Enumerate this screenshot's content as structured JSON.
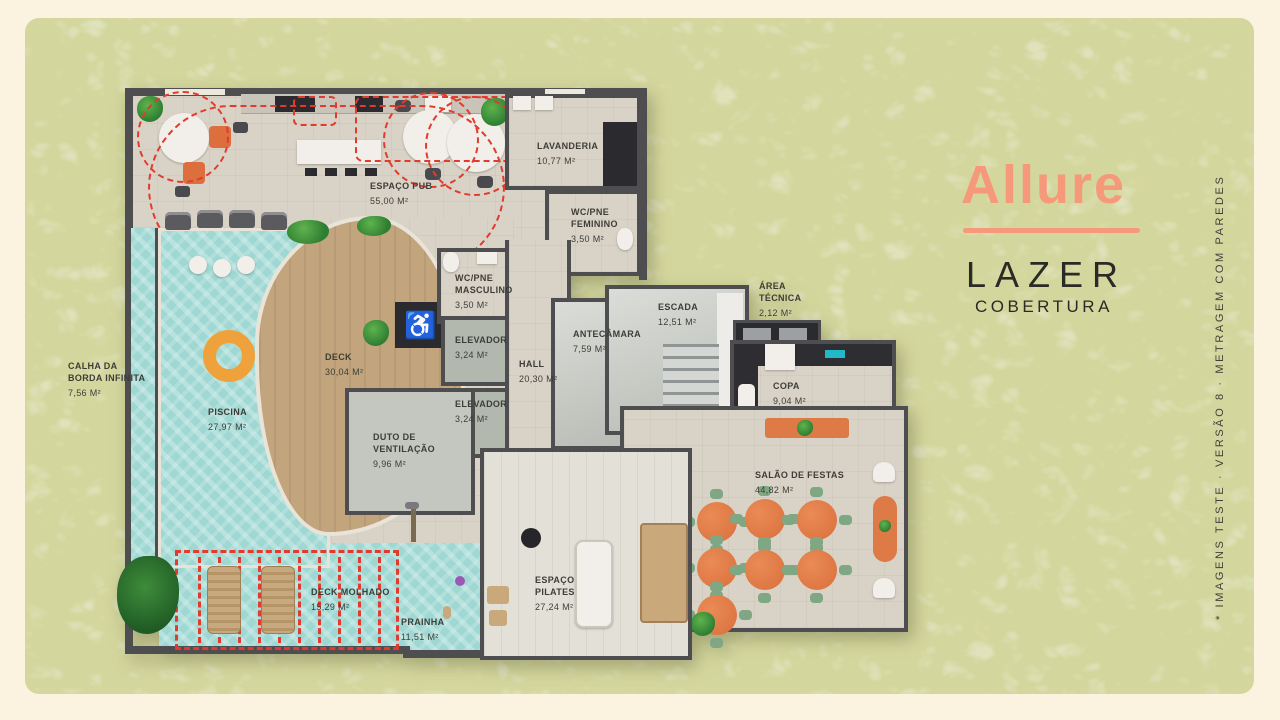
{
  "brand": {
    "logo_text": "Allure",
    "title": "LAZER",
    "subtitle": "COBERTURA",
    "side_note": "* IMAGENS TESTE · VERSÃO 8 · METRAGEM COM PAREDES"
  },
  "colors": {
    "panel_green": "#D4D79D",
    "frame_cream": "#FBF2DF",
    "logo_coral": "#F6997A",
    "dashed_red": "#E23B2E",
    "pool_water": "#9FD8D3",
    "deck_wood": "#C2A47D",
    "table_orange": "#D96F3C"
  },
  "plan": {
    "rooms": [
      {
        "name": "CALHA DA BORDA INFINITA",
        "area": "7,56 M²"
      },
      {
        "name": "ESPAÇO PUB",
        "area": "55,00 M²"
      },
      {
        "name": "LAVANDERIA",
        "area": "10,77 M²"
      },
      {
        "name": "WC/PNE FEMININO",
        "area": "3,50 M²"
      },
      {
        "name": "WC/PNE MASCULINO",
        "area": "3,50 M²"
      },
      {
        "name": "ELEVADOR",
        "area": "3,24 M²"
      },
      {
        "name": "ELEVADOR",
        "area": "3,24 M²"
      },
      {
        "name": "HALL",
        "area": "20,30 M²"
      },
      {
        "name": "ANTECÂMARA",
        "area": "7,59 M²"
      },
      {
        "name": "ESCADA",
        "area": "12,51 M²"
      },
      {
        "name": "ÁREA TÉCNICA",
        "area": "2,12 M²"
      },
      {
        "name": "COPA",
        "area": "9,04 M²"
      },
      {
        "name": "SALÃO DE FESTAS",
        "area": "44,82 M²"
      },
      {
        "name": "DUTO DE VENTILAÇÃO",
        "area": "9,96 M²"
      },
      {
        "name": "DECK",
        "area": "30,04 M²"
      },
      {
        "name": "PISCINA",
        "area": "27,97 M²"
      },
      {
        "name": "DECK MOLHADO",
        "area": "15,29 M²"
      },
      {
        "name": "PRAINHA",
        "area": "11,51 M²"
      },
      {
        "name": "ESPAÇO PILATES",
        "area": "27,24 M²"
      }
    ]
  }
}
